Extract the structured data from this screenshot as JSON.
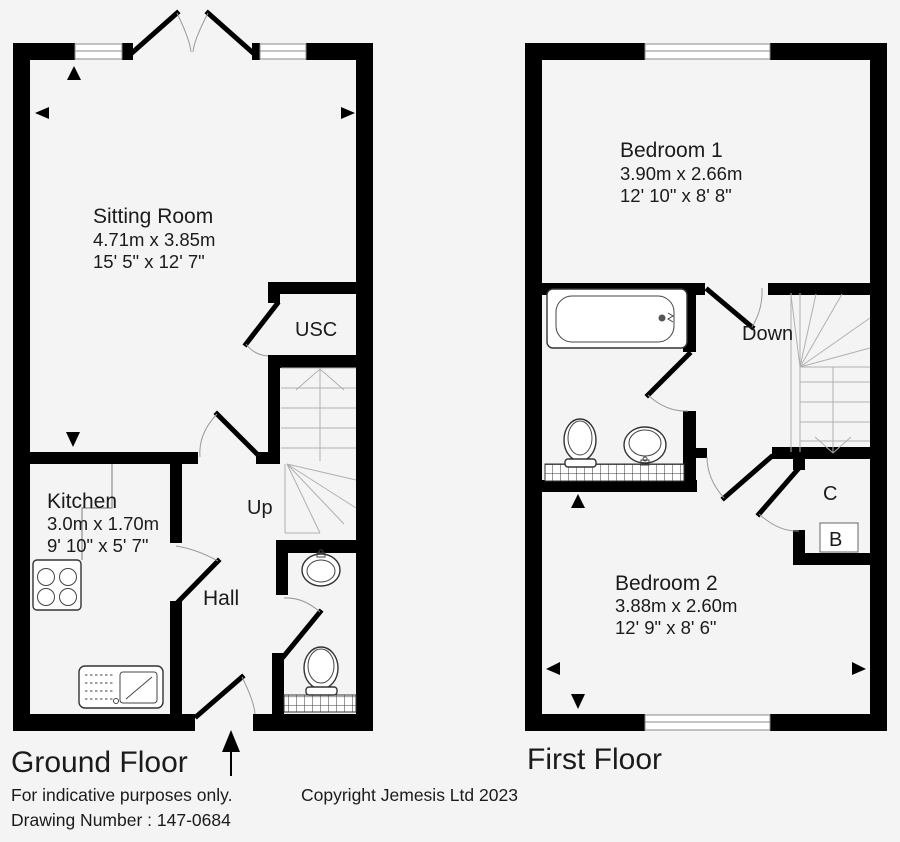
{
  "ground_floor": {
    "title": "Ground Floor",
    "rooms": {
      "sitting_room": {
        "name": "Sitting Room",
        "metric": "4.71m x 3.85m",
        "imperial": "15' 5\" x 12' 7\""
      },
      "kitchen": {
        "name": "Kitchen",
        "metric": "3.0m x 1.70m",
        "imperial": "9' 10\" x 5' 7\""
      },
      "hall": {
        "name": "Hall"
      },
      "usc": {
        "name": "USC"
      },
      "stairs": {
        "label": "Up"
      }
    }
  },
  "first_floor": {
    "title": "First Floor",
    "rooms": {
      "bedroom1": {
        "name": "Bedroom 1",
        "metric": "3.90m x 2.66m",
        "imperial": "12' 10\" x 8' 8\""
      },
      "bedroom2": {
        "name": "Bedroom 2",
        "metric": "3.88m x 2.60m",
        "imperial": "12' 9\" x 8' 6\""
      },
      "stairs": {
        "label": "Down"
      },
      "cupboard": {
        "label": "C"
      },
      "boiler": {
        "label": "B"
      }
    }
  },
  "footer": {
    "disclaimer": "For indicative purposes only.",
    "drawing_number": "Drawing Number : 147-0684",
    "copyright": "Copyright Jemesis Ltd 2023"
  },
  "colors": {
    "background": "#f4f4f4",
    "wall": "#000000",
    "text": "#1b1b1b"
  }
}
